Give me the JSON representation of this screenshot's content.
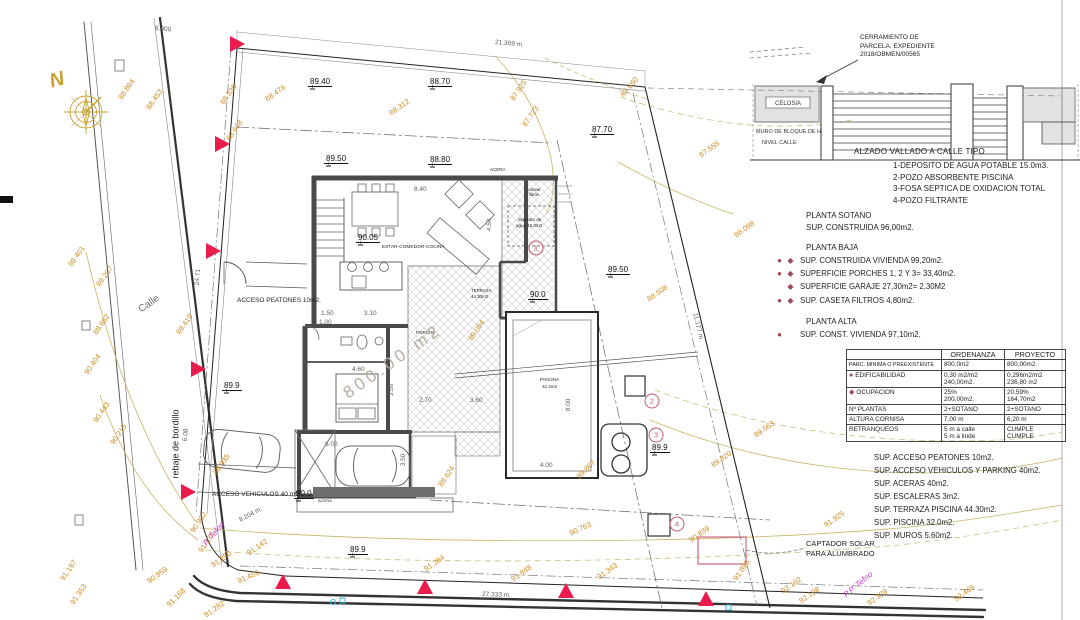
{
  "colors": {
    "contour_label": "#cd8a1d",
    "contour_line": "#c9b465",
    "marker_red": "#e91c4b",
    "legend_bullet": "#9b4a55",
    "circled_number": "#c4596a",
    "purple": "#c93fc9",
    "cyan": "#35b8d8",
    "pink_rect": "#c76a82",
    "compass": "#c8a22a",
    "wall": "#4a4a4a"
  },
  "title_block": {
    "cerramiento": [
      "CERRAMIENTO DE",
      "PARCELA. EXPEDIENTE",
      "2018/OBMEN/00565"
    ],
    "fence": {
      "celosia": "CELOSIA",
      "muro": "MURO DE BLOQUE DE H.",
      "nivel": "NIVEL CALLE"
    },
    "alzado_title": "ALZADO VALLADO A CALLE TIPO",
    "alzado_items": [
      "1-DEPOSITO DE AGUA POTABLE 15.0m3.",
      "2-POZO ABSORBENTE PISCINA",
      "3-FOSA SEPTICA DE OXIDACION TOTAL",
      "4-POZO FILTRANTE"
    ]
  },
  "plantas": {
    "sotano_title": "PLANTA SOTANO",
    "sotano_line": "SUP. CONSTRUIDA 96,00m2.",
    "baja_title": "PLANTA BAJA",
    "baja_items": [
      {
        "b": "cd",
        "t": "SUP. CONSTRUIDA VIVIENDA 99,20m2."
      },
      {
        "b": "cd",
        "t": "SUPERFICIE PORCHES 1, 2 Y 3= 33,40m2."
      },
      {
        "b": "d",
        "t": "SUPERFICIE GARAJE 27,30m2= 2,30M2"
      },
      {
        "b": "cd",
        "t": "SUP. CASETA FILTROS 4,80m2."
      }
    ],
    "alta_title": "PLANTA ALTA",
    "alta_items": [
      {
        "b": "c",
        "t": "SUP. CONST. VIVIENDA 97,10m2."
      }
    ]
  },
  "table": {
    "headers": [
      "",
      "ORDENANZA",
      "PROYECTO"
    ],
    "rows": [
      {
        "b": "",
        "label": "PARC. MINIMA O PREEXISTENTE",
        "ord": [
          "800,0m2"
        ],
        "proy": [
          "800,00m2."
        ],
        "small": true
      },
      {
        "b": "c",
        "label": "EDIFICABILIDAD",
        "ord": [
          "0,30 m2/m2",
          "240,00m2."
        ],
        "proy": [
          "0,296m2/m2",
          "236,80 m2"
        ]
      },
      {
        "b": "d",
        "label": "OCUPACION",
        "ord": [
          "25%",
          "200,00m2."
        ],
        "proy": [
          "20,59%",
          "164,70m2"
        ]
      },
      {
        "b": "",
        "label": "Nº PLANTAS",
        "ord": [
          "2+SOTANO"
        ],
        "proy": [
          "2+SOTANO"
        ]
      },
      {
        "b": "",
        "label": "ALTURA CORNISA",
        "ord": [
          "7,00 m"
        ],
        "proy": [
          "6,20 m"
        ]
      },
      {
        "b": "",
        "label": "RETRANQUEOS",
        "ord": [
          "5 m a calle",
          "5 m a linde"
        ],
        "proy": [
          "CUMPLE",
          "CUMPLE"
        ]
      }
    ]
  },
  "sup_list": [
    "SUP. ACCESO PEATONES 10m2.",
    "SUP. ACCESO VEHICULOS Y PARKING 40m2.",
    "SUP. ACERAS 40m2.",
    "SUP. ESCALERAS 3m2.",
    "SUP. TERRAZA PISCINA 44.30m2.",
    "SUP. PISCINA 32.0m2.",
    "SUP. MUROS  5.60m2."
  ],
  "annotations": {
    "labels": [
      {
        "t": "ACCESO PEATONES 10m2.",
        "x": 237,
        "y": 298,
        "s": 6.5,
        "c": "k"
      },
      {
        "t": "ACCESO VEHICULOS 40 m2.",
        "x": 212,
        "y": 492,
        "s": 6.5,
        "c": "k"
      },
      {
        "t": "ESTAR-COMEDOR-COCINA",
        "x": 382,
        "y": 246,
        "s": 4.8,
        "c": "k"
      },
      {
        "t": "PORCHE",
        "x": 416,
        "y": 331,
        "s": 4.5,
        "c": "k"
      },
      {
        "t": "TERRAZA",
        "x": 471,
        "y": 289,
        "s": 4.4,
        "c": "k"
      },
      {
        "t": "44.30m2",
        "x": 471,
        "y": 295,
        "s": 4.4,
        "c": "k"
      },
      {
        "t": "PISCINA",
        "x": 540,
        "y": 379,
        "s": 4.8,
        "c": "k"
      },
      {
        "t": "32.4m2",
        "x": 542,
        "y": 385,
        "s": 4.5,
        "c": "k"
      },
      {
        "t": "caseta",
        "x": 528,
        "y": 188,
        "s": 4.2,
        "c": "k"
      },
      {
        "t": "filtros",
        "x": 529,
        "y": 193,
        "s": 4.2,
        "c": "k"
      },
      {
        "t": "deposito de",
        "x": 518,
        "y": 218,
        "s": 4.5,
        "c": "k"
      },
      {
        "t": "agua 15.0m3",
        "x": 516,
        "y": 224,
        "s": 4.5,
        "c": "k"
      },
      {
        "t": "ACERA",
        "x": 490,
        "y": 168,
        "s": 4.5,
        "c": "k"
      },
      {
        "t": "ACERA",
        "x": 318,
        "y": 499,
        "s": 4.0,
        "c": "k"
      },
      {
        "t": "Calle",
        "x": 140,
        "y": 306,
        "r": -35,
        "s": 10,
        "c": "g"
      },
      {
        "t": "rebaje de bordillo",
        "x": 176,
        "y": 474,
        "r": -90,
        "s": 9,
        "c": "k"
      },
      {
        "t": "P. Tefno",
        "x": 205,
        "y": 541,
        "r": -50,
        "s": 8,
        "c": "p"
      },
      {
        "t": "P.P. Tefno",
        "x": 845,
        "y": 592,
        "r": -40,
        "s": 8,
        "c": "p"
      },
      {
        "t": "800.00 m2",
        "x": 345,
        "y": 386,
        "r": -35,
        "s": 17,
        "c": "o"
      },
      {
        "t": "CAPTADOR SOLAR",
        "x": 806,
        "y": 540,
        "s": 7.5,
        "c": "k"
      },
      {
        "t": "PARA ALUMBRADO",
        "x": 806,
        "y": 550,
        "s": 7.5,
        "c": "k"
      },
      {
        "t": "N",
        "x": 50,
        "y": 72,
        "r": -15,
        "s": 20,
        "c": "n"
      }
    ]
  },
  "contour_labels": [
    {
      "v": "88.884",
      "x": 120,
      "y": 95,
      "r": -55
    },
    {
      "v": "88.453",
      "x": 148,
      "y": 105,
      "r": -55
    },
    {
      "v": "88.336",
      "x": 222,
      "y": 100,
      "r": -55
    },
    {
      "v": "88.476",
      "x": 266,
      "y": 96,
      "r": -35
    },
    {
      "v": "88.608",
      "x": 228,
      "y": 136,
      "r": -55
    },
    {
      "v": "88.312",
      "x": 390,
      "y": 110,
      "r": -35
    },
    {
      "v": "87.925",
      "x": 512,
      "y": 96,
      "r": -55
    },
    {
      "v": "87.723",
      "x": 524,
      "y": 122,
      "r": -55
    },
    {
      "v": "88.650",
      "x": 622,
      "y": 92,
      "r": -50
    },
    {
      "v": "87.555",
      "x": 700,
      "y": 152,
      "r": -35
    },
    {
      "v": "88.098",
      "x": 735,
      "y": 232,
      "r": -35
    },
    {
      "v": "88.508",
      "x": 648,
      "y": 296,
      "r": -35
    },
    {
      "v": "89.401",
      "x": 70,
      "y": 262,
      "r": -55
    },
    {
      "v": "89.207",
      "x": 98,
      "y": 282,
      "r": -55
    },
    {
      "v": "89.662",
      "x": 95,
      "y": 330,
      "r": -55
    },
    {
      "v": "90.404",
      "x": 86,
      "y": 370,
      "r": -55
    },
    {
      "v": "89.419",
      "x": 178,
      "y": 330,
      "r": -55
    },
    {
      "v": "90.443",
      "x": 95,
      "y": 418,
      "r": -55
    },
    {
      "v": "90.215",
      "x": 112,
      "y": 440,
      "r": -55
    },
    {
      "v": "89.935",
      "x": 215,
      "y": 470,
      "r": -55
    },
    {
      "v": "89.624",
      "x": 440,
      "y": 482,
      "r": -55
    },
    {
      "v": "89.094",
      "x": 470,
      "y": 336,
      "r": -55
    },
    {
      "v": "89.867",
      "x": 578,
      "y": 474,
      "r": -45
    },
    {
      "v": "89.820",
      "x": 712,
      "y": 462,
      "r": -35
    },
    {
      "v": "89.563",
      "x": 755,
      "y": 432,
      "r": -35
    },
    {
      "v": "90.902",
      "x": 192,
      "y": 528,
      "r": -55
    },
    {
      "v": "91.137",
      "x": 200,
      "y": 548,
      "r": -55
    },
    {
      "v": "91.250",
      "x": 212,
      "y": 562,
      "r": -35
    },
    {
      "v": "91.142",
      "x": 248,
      "y": 550,
      "r": -35
    },
    {
      "v": "91.459",
      "x": 238,
      "y": 578,
      "r": -25
    },
    {
      "v": "90.959",
      "x": 148,
      "y": 578,
      "r": -35
    },
    {
      "v": "91.168",
      "x": 168,
      "y": 602,
      "r": -45
    },
    {
      "v": "91.282",
      "x": 205,
      "y": 612,
      "r": -35
    },
    {
      "v": "91.197",
      "x": 62,
      "y": 576,
      "r": -55
    },
    {
      "v": "91.353",
      "x": 72,
      "y": 600,
      "r": -55
    },
    {
      "v": "90.763",
      "x": 570,
      "y": 530,
      "r": -25
    },
    {
      "v": "91.384",
      "x": 425,
      "y": 566,
      "r": -35
    },
    {
      "v": "91.848",
      "x": 512,
      "y": 576,
      "r": -35
    },
    {
      "v": "91.343",
      "x": 598,
      "y": 574,
      "r": -35
    },
    {
      "v": "91.925",
      "x": 825,
      "y": 522,
      "r": -35
    },
    {
      "v": "90.839",
      "x": 690,
      "y": 537,
      "r": -35
    },
    {
      "v": "91.895",
      "x": 735,
      "y": 576,
      "r": -55
    },
    {
      "v": "92.192",
      "x": 782,
      "y": 588,
      "r": -35
    },
    {
      "v": "92.198",
      "x": 800,
      "y": 598,
      "r": -35
    },
    {
      "v": "92.329",
      "x": 868,
      "y": 600,
      "r": -35
    },
    {
      "v": "92.468",
      "x": 955,
      "y": 596,
      "r": -35
    }
  ],
  "spot_elevations": [
    {
      "v": "89.40",
      "x": 308,
      "y": 78
    },
    {
      "v": "88.70",
      "x": 428,
      "y": 78
    },
    {
      "v": "87.70",
      "x": 590,
      "y": 126
    },
    {
      "v": "89.50",
      "x": 324,
      "y": 155
    },
    {
      "v": "88.80",
      "x": 428,
      "y": 156
    },
    {
      "v": "90.05",
      "x": 356,
      "y": 234
    },
    {
      "v": "90.0",
      "x": 528,
      "y": 291
    },
    {
      "v": "89.50",
      "x": 606,
      "y": 266
    },
    {
      "v": "89.9",
      "x": 222,
      "y": 382
    },
    {
      "v": "89.9",
      "x": 650,
      "y": 444
    },
    {
      "v": "89.9",
      "x": 348,
      "y": 546
    },
    {
      "v": "90.0",
      "x": 294,
      "y": 490
    }
  ],
  "dimensions": [
    {
      "t": "21.309 m.",
      "x": 495,
      "y": 40,
      "r": 5
    },
    {
      "t": "27.333 m.",
      "x": 482,
      "y": 592,
      "r": 2
    },
    {
      "t": "11.177 m",
      "x": 694,
      "y": 310,
      "r": 77
    },
    {
      "t": "24.71",
      "x": 198,
      "y": 282,
      "r": -85
    },
    {
      "t": "8.204 m.",
      "x": 240,
      "y": 518,
      "r": -28
    },
    {
      "t": "6.08",
      "x": 186,
      "y": 438,
      "r": -85
    },
    {
      "t": "6.000",
      "x": 155,
      "y": 26,
      "r": 5
    },
    {
      "t": "8.40",
      "x": 414,
      "y": 187
    },
    {
      "t": "4.50",
      "x": 490,
      "y": 228,
      "r": -90
    },
    {
      "t": "1.50",
      "x": 321,
      "y": 311
    },
    {
      "t": "1.00",
      "x": 319,
      "y": 320
    },
    {
      "t": "3.10",
      "x": 364,
      "y": 311
    },
    {
      "t": "4.60",
      "x": 352,
      "y": 367
    },
    {
      "t": "3.50",
      "x": 392,
      "y": 393,
      "r": -90
    },
    {
      "t": "6.00",
      "x": 325,
      "y": 442
    },
    {
      "t": "3.50",
      "x": 404,
      "y": 463,
      "r": -90
    },
    {
      "t": "2.70",
      "x": 419,
      "y": 398
    },
    {
      "t": "3.60",
      "x": 470,
      "y": 398
    },
    {
      "t": "8.00",
      "x": 569,
      "y": 408,
      "r": -90
    },
    {
      "t": "4.00",
      "x": 540,
      "y": 463
    }
  ],
  "markers": {
    "triangles": [
      {
        "x": 230,
        "y": 44,
        "d": "r"
      },
      {
        "x": 215,
        "y": 144,
        "d": "r"
      },
      {
        "x": 206,
        "y": 251,
        "d": "r"
      },
      {
        "x": 191,
        "y": 369,
        "d": "r"
      },
      {
        "x": 181,
        "y": 492,
        "d": "r"
      },
      {
        "x": 283,
        "y": 589,
        "d": "u"
      },
      {
        "x": 425,
        "y": 594,
        "d": "u"
      },
      {
        "x": 566,
        "y": 598,
        "d": "u"
      },
      {
        "x": 706,
        "y": 606,
        "d": "u"
      }
    ],
    "circled": [
      {
        "n": "1",
        "x": 536,
        "y": 248
      },
      {
        "n": "2",
        "x": 652,
        "y": 401
      },
      {
        "n": "3",
        "x": 656,
        "y": 435
      },
      {
        "n": "4",
        "x": 677,
        "y": 524
      }
    ],
    "cyan_marks": [
      {
        "x": 333,
        "y": 602,
        "shape": "circle"
      },
      {
        "x": 340,
        "y": 598,
        "shape": "square"
      },
      {
        "x": 726,
        "y": 605,
        "shape": "square"
      }
    ]
  }
}
